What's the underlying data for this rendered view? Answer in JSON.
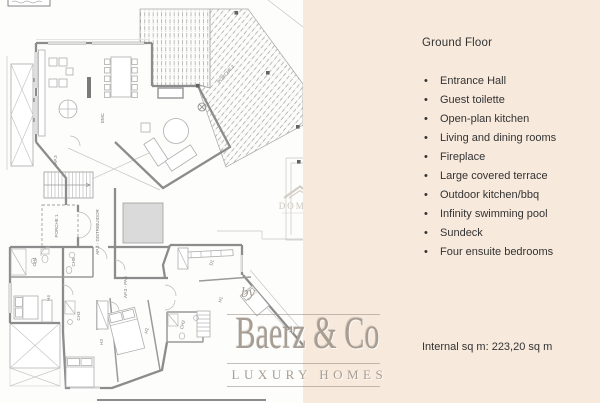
{
  "right_panel": {
    "heading": "Ground Floor",
    "bullets": [
      "Entrance Hall",
      "Guest toilette",
      "Open-plan kitchen",
      "Living and dining rooms",
      "Fireplace",
      "Large covered terrace",
      "Outdoor kitchen/bbq",
      "Infinity swimming pool",
      "Sundeck",
      "Four ensuite bedrooms"
    ],
    "internal_area": "Internal sq m: 223,20 sq m"
  },
  "branding": {
    "by_label": "by",
    "name": "Baerz & Co",
    "tagline": "LUXURY HOMES"
  },
  "watermark": {
    "text": "DOMUS"
  },
  "floorplan": {
    "room_labels": [
      "EMC",
      "AP.3",
      "PORCHE 1",
      "AP.3 - DISTRIBUIDOR",
      "AP.3 - PAS",
      "CH4",
      "CH5",
      "CH3",
      "CH2",
      "D1",
      "H1",
      "H2",
      "H3",
      "H4",
      "PORCHE 2"
    ]
  },
  "colors": {
    "panel_bg": "#f7e9dc",
    "text": "#333333",
    "brand": "#a79d92",
    "wall": "#8c8c8c",
    "watermark": "#cfc9c0"
  }
}
